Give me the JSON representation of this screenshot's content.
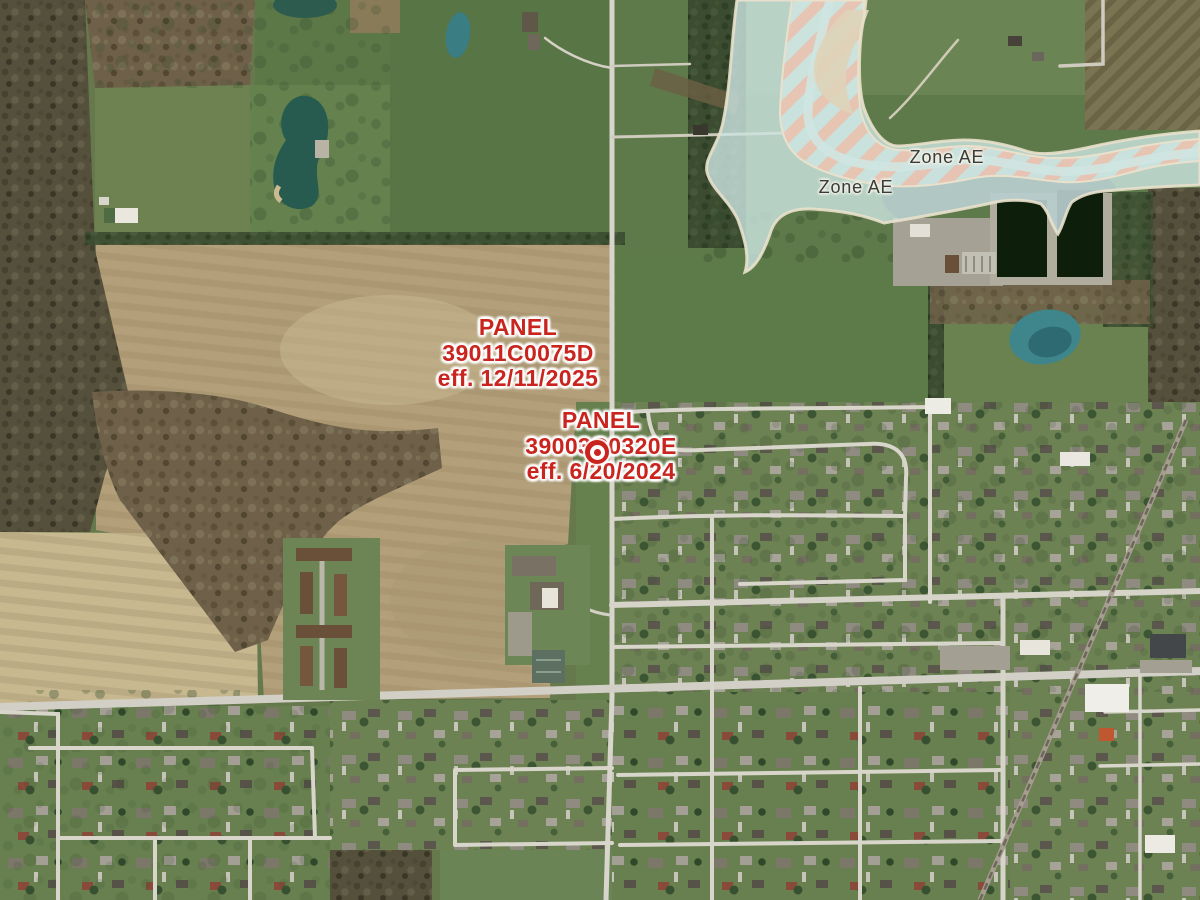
{
  "map": {
    "flood_zone_labels": [
      {
        "text": "Zone AE"
      },
      {
        "text": "Zone AE"
      }
    ],
    "panel_labels": [
      {
        "title": "PANEL",
        "panel_number": "39011C0075D",
        "effective": "eff. 12/11/2025"
      },
      {
        "title": "PANEL",
        "panel_number": "39003C0320E",
        "effective": "eff. 6/20/2024"
      }
    ],
    "marker": {
      "icon": "target-circle-icon",
      "color": "#c9241d"
    },
    "colors": {
      "panel_label_red": "#c9241d",
      "zone_label_gray": "#3b3b3b",
      "flood_zone_fill": "#cbe3df",
      "floodway_stripe_salmon": "#edc3b1",
      "flood_zone_border_cream": "#e9e1cc"
    }
  }
}
